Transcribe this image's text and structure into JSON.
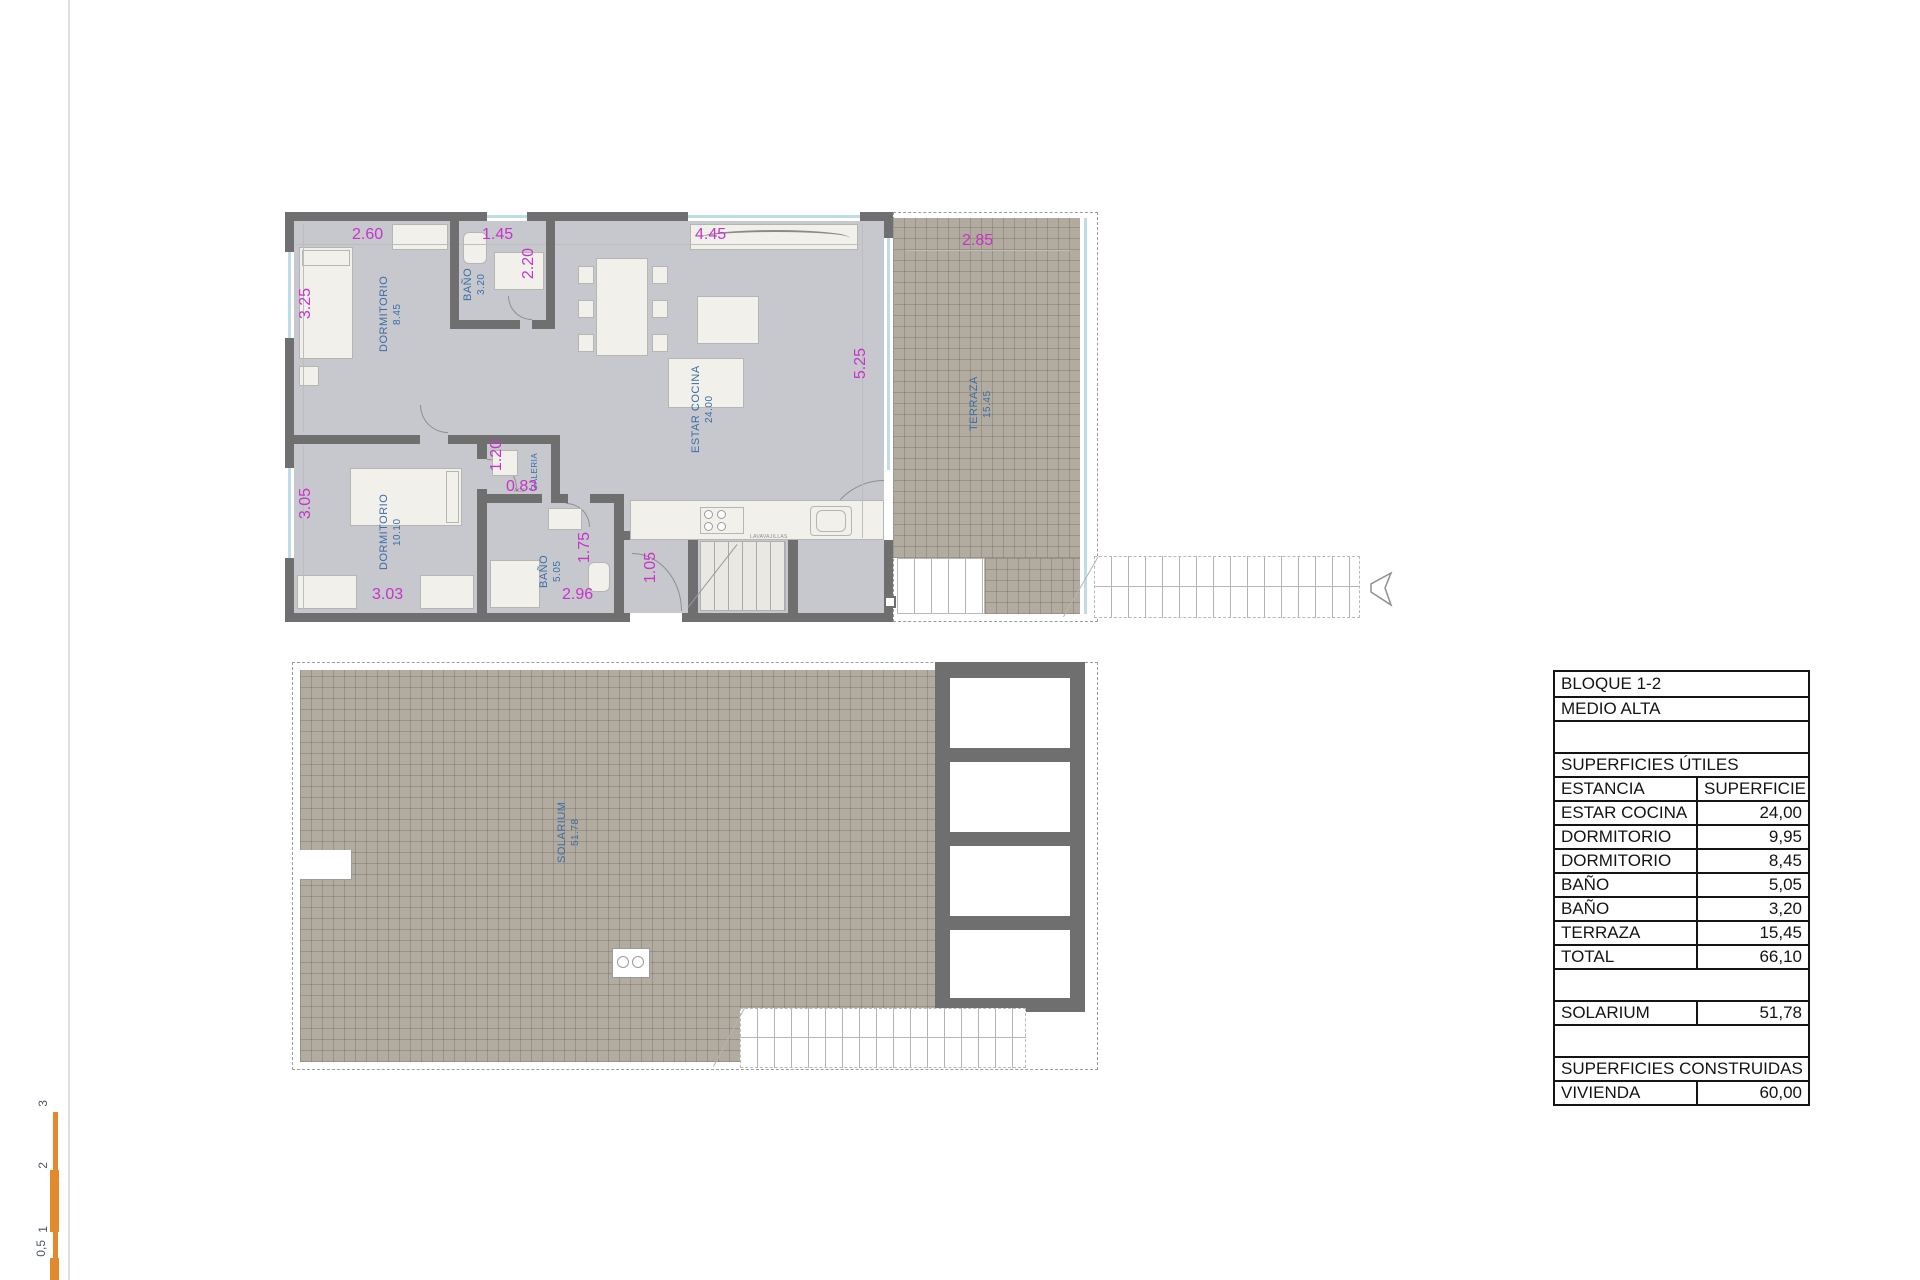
{
  "drawing": {
    "scale_bar": {
      "labels": [
        "0,5",
        "1",
        "2",
        "3"
      ]
    },
    "upper_plan": {
      "rooms": {
        "dorm1": {
          "name": "DORMITORIO",
          "area": "8.45"
        },
        "bath1": {
          "name": "BAÑO",
          "area": "3.20"
        },
        "living": {
          "name": "ESTAR COCINA",
          "area": "24.00"
        },
        "terrace": {
          "name": "TERRAZA",
          "area": "15.45"
        },
        "dorm2": {
          "name": "DORMITORIO",
          "area": "10.10"
        },
        "bath2": {
          "name": "BAÑO",
          "area": "5.05"
        },
        "galeria": {
          "name": "GALERIA"
        }
      },
      "dims": {
        "dorm1_top": "2.60",
        "bath1_top": "1.45",
        "living_top": "4.45",
        "terrace_top": "2.85",
        "dorm1_left": "3.25",
        "bath1_right": "2.20",
        "living_right": "5.25",
        "galeria_w": "1.20",
        "galeria_h": "0.83",
        "dorm2_left": "3.05",
        "bath2_right": "1.75",
        "dorm2_bottom": "3.03",
        "bath2_bottom": "2.96",
        "hall": "1.05"
      },
      "annotations": {
        "acs": "ACS",
        "dishwasher": "LAVAVAJILLAS"
      }
    },
    "lower_plan": {
      "rooms": {
        "solarium": {
          "name": "SOLARIUM",
          "area": "51.78"
        }
      }
    },
    "table": {
      "rows": [
        {
          "label": "BLOQUE 1-2",
          "value": ""
        },
        {
          "label": "MEDIO ALTA",
          "value": ""
        },
        {
          "label": "",
          "value": ""
        },
        {
          "label": "SUPERFICIES ÚTILES",
          "value": ""
        },
        {
          "label": "ESTANCIA",
          "value": "SUPERFICIE"
        },
        {
          "label": "ESTAR COCINA",
          "value": "24,00"
        },
        {
          "label": "DORMITORIO",
          "value": "9,95"
        },
        {
          "label": "DORMITORIO",
          "value": "8,45"
        },
        {
          "label": "BAÑO",
          "value": "5,05"
        },
        {
          "label": "BAÑO",
          "value": "3,20"
        },
        {
          "label": "TERRAZA",
          "value": "15,45"
        },
        {
          "label": "TOTAL",
          "value": "66,10"
        },
        {
          "label": "",
          "value": ""
        },
        {
          "label": "SOLARIUM",
          "value": "51,78"
        },
        {
          "label": "",
          "value": ""
        },
        {
          "label": "SUPERFICIES CONSTRUIDAS",
          "value": ""
        },
        {
          "label": "VIVIENDA",
          "value": "60,00"
        }
      ]
    },
    "colors": {
      "wall": "#6f6f6f",
      "floor": "#c7c7ce",
      "hatch": "#b2aba0",
      "dim_text": "#c833c8",
      "room_label": "#3a6da6",
      "scale_bar": "#e2892b"
    }
  }
}
